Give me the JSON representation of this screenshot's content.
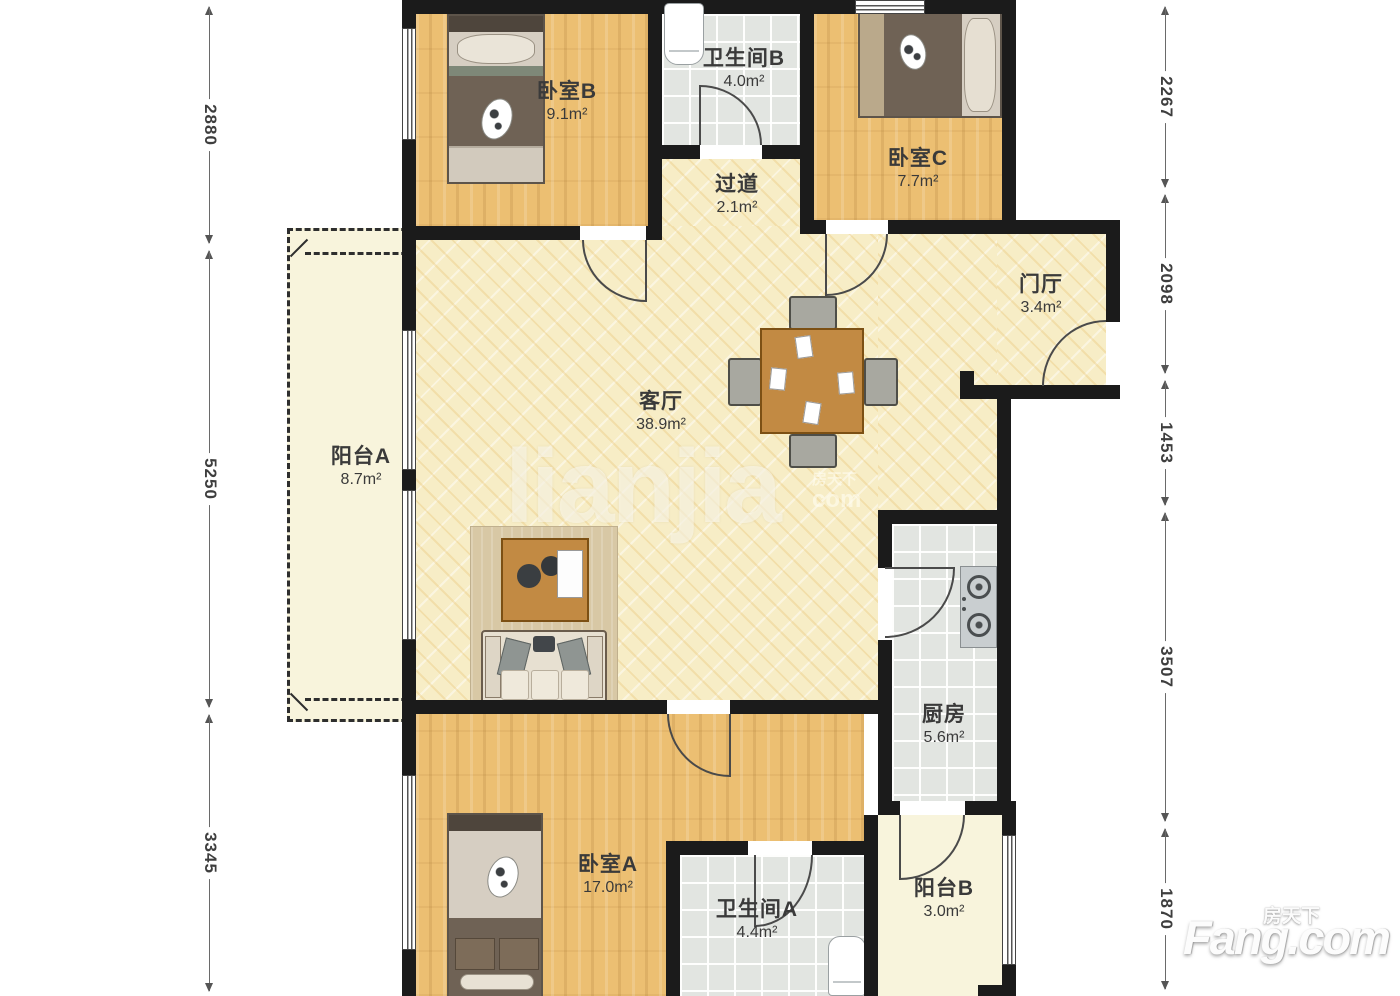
{
  "page": {
    "type": "apartment-floor-plan",
    "background": "#ffffff"
  },
  "rooms": [
    {
      "key": "bedroom-b",
      "name": "卧室B",
      "area": "9.1m²"
    },
    {
      "key": "bathroom-b",
      "name": "卫生间B",
      "area": "4.0m²"
    },
    {
      "key": "bedroom-c",
      "name": "卧室C",
      "area": "7.7m²"
    },
    {
      "key": "hallway",
      "name": "过道",
      "area": "2.1m²"
    },
    {
      "key": "foyer",
      "name": "门厅",
      "area": "3.4m²"
    },
    {
      "key": "living-room",
      "name": "客厅",
      "area": "38.9m²"
    },
    {
      "key": "balcony-a",
      "name": "阳台A",
      "area": "8.7m²"
    },
    {
      "key": "kitchen",
      "name": "厨房",
      "area": "5.6m²"
    },
    {
      "key": "bedroom-a",
      "name": "卧室A",
      "area": "17.0m²"
    },
    {
      "key": "bathroom-a",
      "name": "卫生间A",
      "area": "4.4m²"
    },
    {
      "key": "balcony-b",
      "name": "阳台B",
      "area": "3.0m²"
    }
  ],
  "dimensions_mm": {
    "left": [
      {
        "label": "2880"
      },
      {
        "label": "5250"
      },
      {
        "label": "3345"
      }
    ],
    "right": [
      {
        "label": "2267"
      },
      {
        "label": "2098"
      },
      {
        "label": "1453"
      },
      {
        "label": "3507"
      },
      {
        "label": "1870"
      }
    ]
  },
  "watermarks": {
    "corner_brand": "Fang.com",
    "corner_brand_cn": "房天下",
    "center_text": "lianjia",
    "center_suffix_cn": "房天下",
    "center_suffix": "com"
  },
  "colors": {
    "wall": "#1b1b1b",
    "wood_floor": "#ecbf72",
    "pale_floor": "#f7edc6",
    "tile_floor": "#e2e5e1",
    "balcony_floor": "#f8f4dc",
    "label_text": "#3a3a3a",
    "dimension_text": "#3e3e3e"
  }
}
